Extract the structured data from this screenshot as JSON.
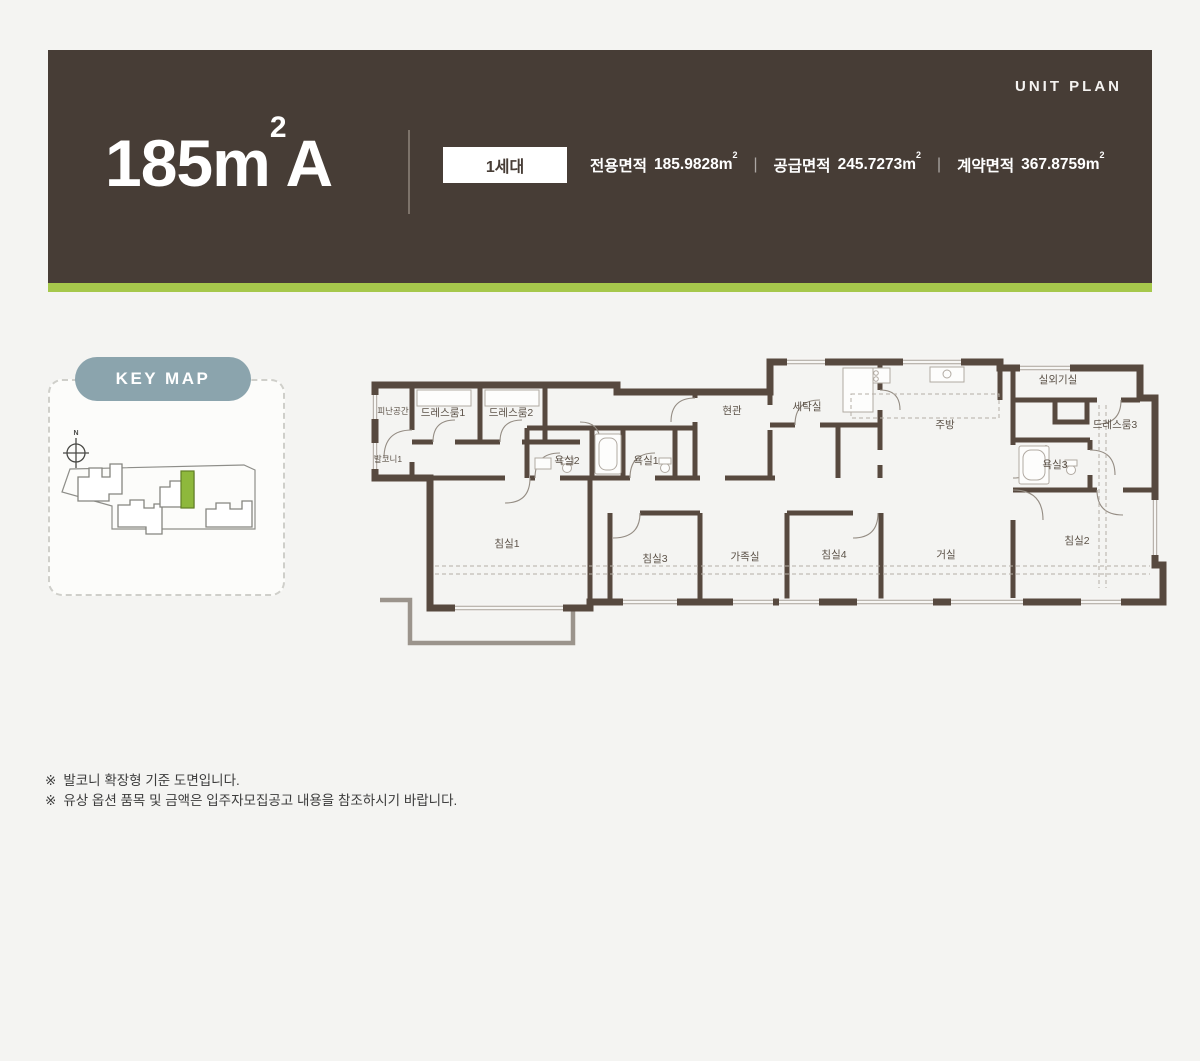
{
  "header": {
    "unit_plan_label": "UNIT PLAN",
    "title_main": "185m",
    "title_sup": "2",
    "title_suffix": "A",
    "badge": "1세대",
    "separator": "|",
    "areas": [
      {
        "label": "전용면적",
        "value": "185.9828m",
        "sup": "2"
      },
      {
        "label": "공급면적",
        "value": "245.7273m",
        "sup": "2"
      },
      {
        "label": "계약면적",
        "value": "367.8759m",
        "sup": "2"
      }
    ],
    "colors": {
      "background": "#473d36",
      "accent_bar": "#a6c84c",
      "text": "#ffffff"
    }
  },
  "keymap": {
    "label": "KEY MAP",
    "compass_label": "N",
    "pill_color": "#8ba4ad",
    "highlight_color": "#8eb83c"
  },
  "floorplan": {
    "wall_color": "#57493f",
    "rooms": [
      {
        "label": "피난공간"
      },
      {
        "label": "드레스룸1"
      },
      {
        "label": "드레스룸2"
      },
      {
        "label": "발코니1"
      },
      {
        "label": "욕실2"
      },
      {
        "label": "욕실1"
      },
      {
        "label": "현관"
      },
      {
        "label": "세탁실"
      },
      {
        "label": "주방"
      },
      {
        "label": "실외기실"
      },
      {
        "label": "드레스룸3"
      },
      {
        "label": "욕실3"
      },
      {
        "label": "침실1"
      },
      {
        "label": "침실3"
      },
      {
        "label": "가족실"
      },
      {
        "label": "침실4"
      },
      {
        "label": "거실"
      },
      {
        "label": "침실2"
      }
    ]
  },
  "notes": [
    {
      "mark": "※",
      "text": "발코니 확장형 기준 도면입니다."
    },
    {
      "mark": "※",
      "text": "유상 옵션 품목 및 금액은 입주자모집공고 내용을 참조하시기 바랍니다."
    }
  ]
}
